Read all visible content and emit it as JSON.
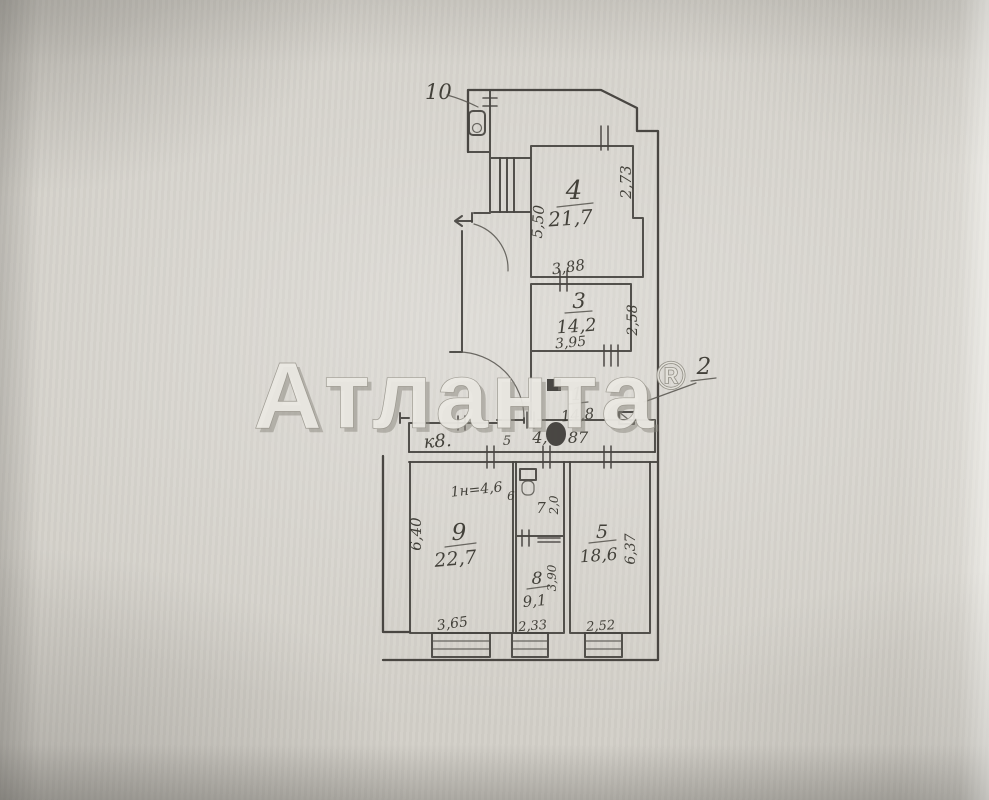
{
  "watermark": {
    "brand": "Атланта",
    "registered": "®"
  },
  "callouts": {
    "top_unit": "10",
    "right_unit": "2"
  },
  "plan": {
    "strip_label": "к8.",
    "note": "1н=4,6",
    "hall": {
      "num": "1",
      "area": "14,8",
      "dim_small": "5",
      "dim_left": "4,",
      "dim_right": "87"
    },
    "room4": {
      "num": "4",
      "area": "21,7",
      "dim_left": "5,50",
      "dim_right": "2,73",
      "dim_bottom": "3,88"
    },
    "room3": {
      "num": "3",
      "area": "14,2",
      "dim_right": "2,58",
      "dim_bottom": "3,95"
    },
    "room9": {
      "num": "9",
      "area": "22,7",
      "dim_left": "6,40",
      "dim_bottom": "3,65"
    },
    "room8": {
      "num": "8",
      "area": "9,1",
      "dim_right": "3,90",
      "dim_bottom": "2,33"
    },
    "room5": {
      "num": "5",
      "area": "18,6",
      "dim_right": "6,37",
      "dim_bottom": "2,52"
    },
    "room7": {
      "num": "7",
      "dim_right": "2,0"
    },
    "room6": {
      "num": "6"
    }
  }
}
